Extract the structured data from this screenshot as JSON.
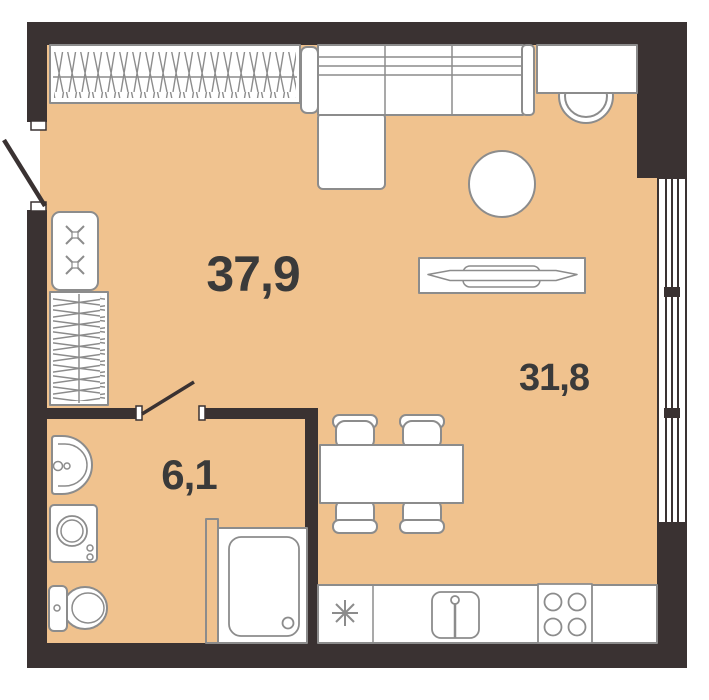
{
  "title": "studio-apartment-floor-plan",
  "areas": {
    "living": {
      "label": "37,9"
    },
    "kitchen": {
      "label": "31,8"
    },
    "bathroom": {
      "label": "6,1"
    }
  },
  "colors": {
    "floor": "#F0C28E",
    "wall": "#3A3232",
    "furniture_outline": "#8C8C8C",
    "label_text": "#3A3A3A",
    "background": "#FFFFFF"
  },
  "icons": {
    "wardrobe": "wardrobe-hatch-icon",
    "entry_closet": "closet-hatch-icon",
    "cooktop_2x": "two-x-cabinet-icon",
    "sofa": "corner-sofa-icon",
    "desk": "desk-icon",
    "desk_chair": "tub-chair-icon",
    "round_table": "round-table-icon",
    "tv_stand": "tv-stand-icon",
    "dining_table": "dining-table-icon",
    "dining_chair": "chair-icon",
    "fridge": "asterisk-icon",
    "kitchen_sink": "sink-faucet-icon",
    "stove": "four-burner-stove-icon",
    "bath_sink": "washbasin-icon",
    "washing_machine": "washing-machine-icon",
    "toilet": "toilet-icon",
    "shower": "shower-tray-icon",
    "entry_door": "door-swing-icon",
    "bathroom_door": "door-swing-icon",
    "window": "window-icon"
  }
}
